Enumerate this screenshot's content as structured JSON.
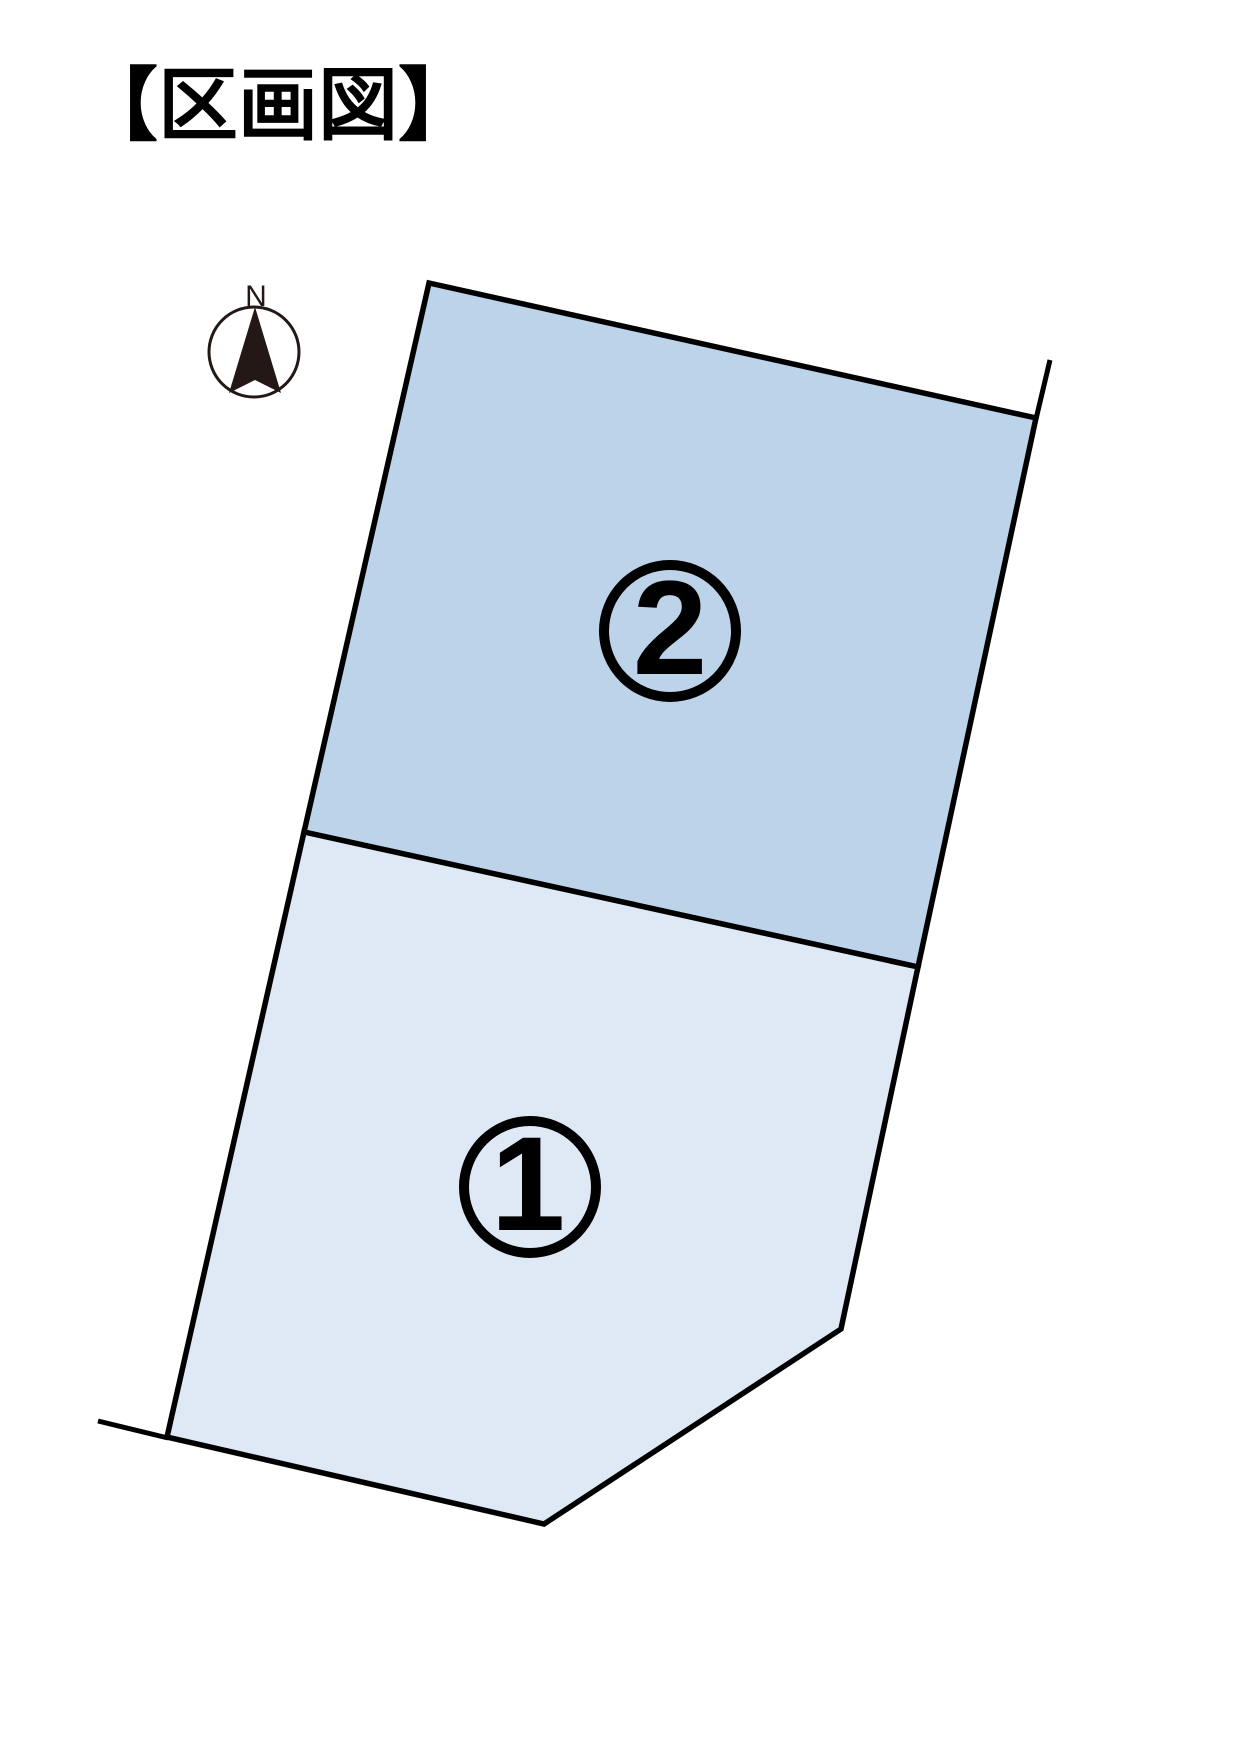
{
  "page": {
    "title": "【区画図】",
    "background": "#ffffff"
  },
  "compass": {
    "label": "N",
    "color": "#231815"
  },
  "map": {
    "outline_color": "#000000",
    "parcels": [
      {
        "number": "1",
        "fill": "#dee9f5"
      },
      {
        "number": "2",
        "fill": "#bdd3ea"
      }
    ]
  }
}
